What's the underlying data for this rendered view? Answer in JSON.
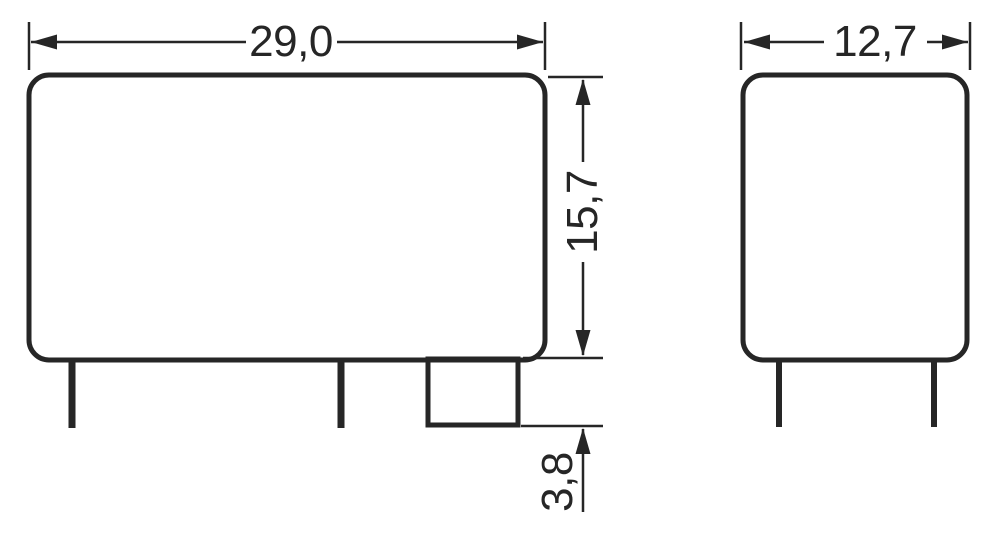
{
  "figure": {
    "type": "technical-dimension-drawing",
    "line_color": "#262626",
    "background_color": "#ffffff",
    "front_view": {
      "width_label": "29,0",
      "height_label": "15,7",
      "pin_length_label": "3,8"
    },
    "side_view": {
      "width_label": "12,7"
    }
  }
}
